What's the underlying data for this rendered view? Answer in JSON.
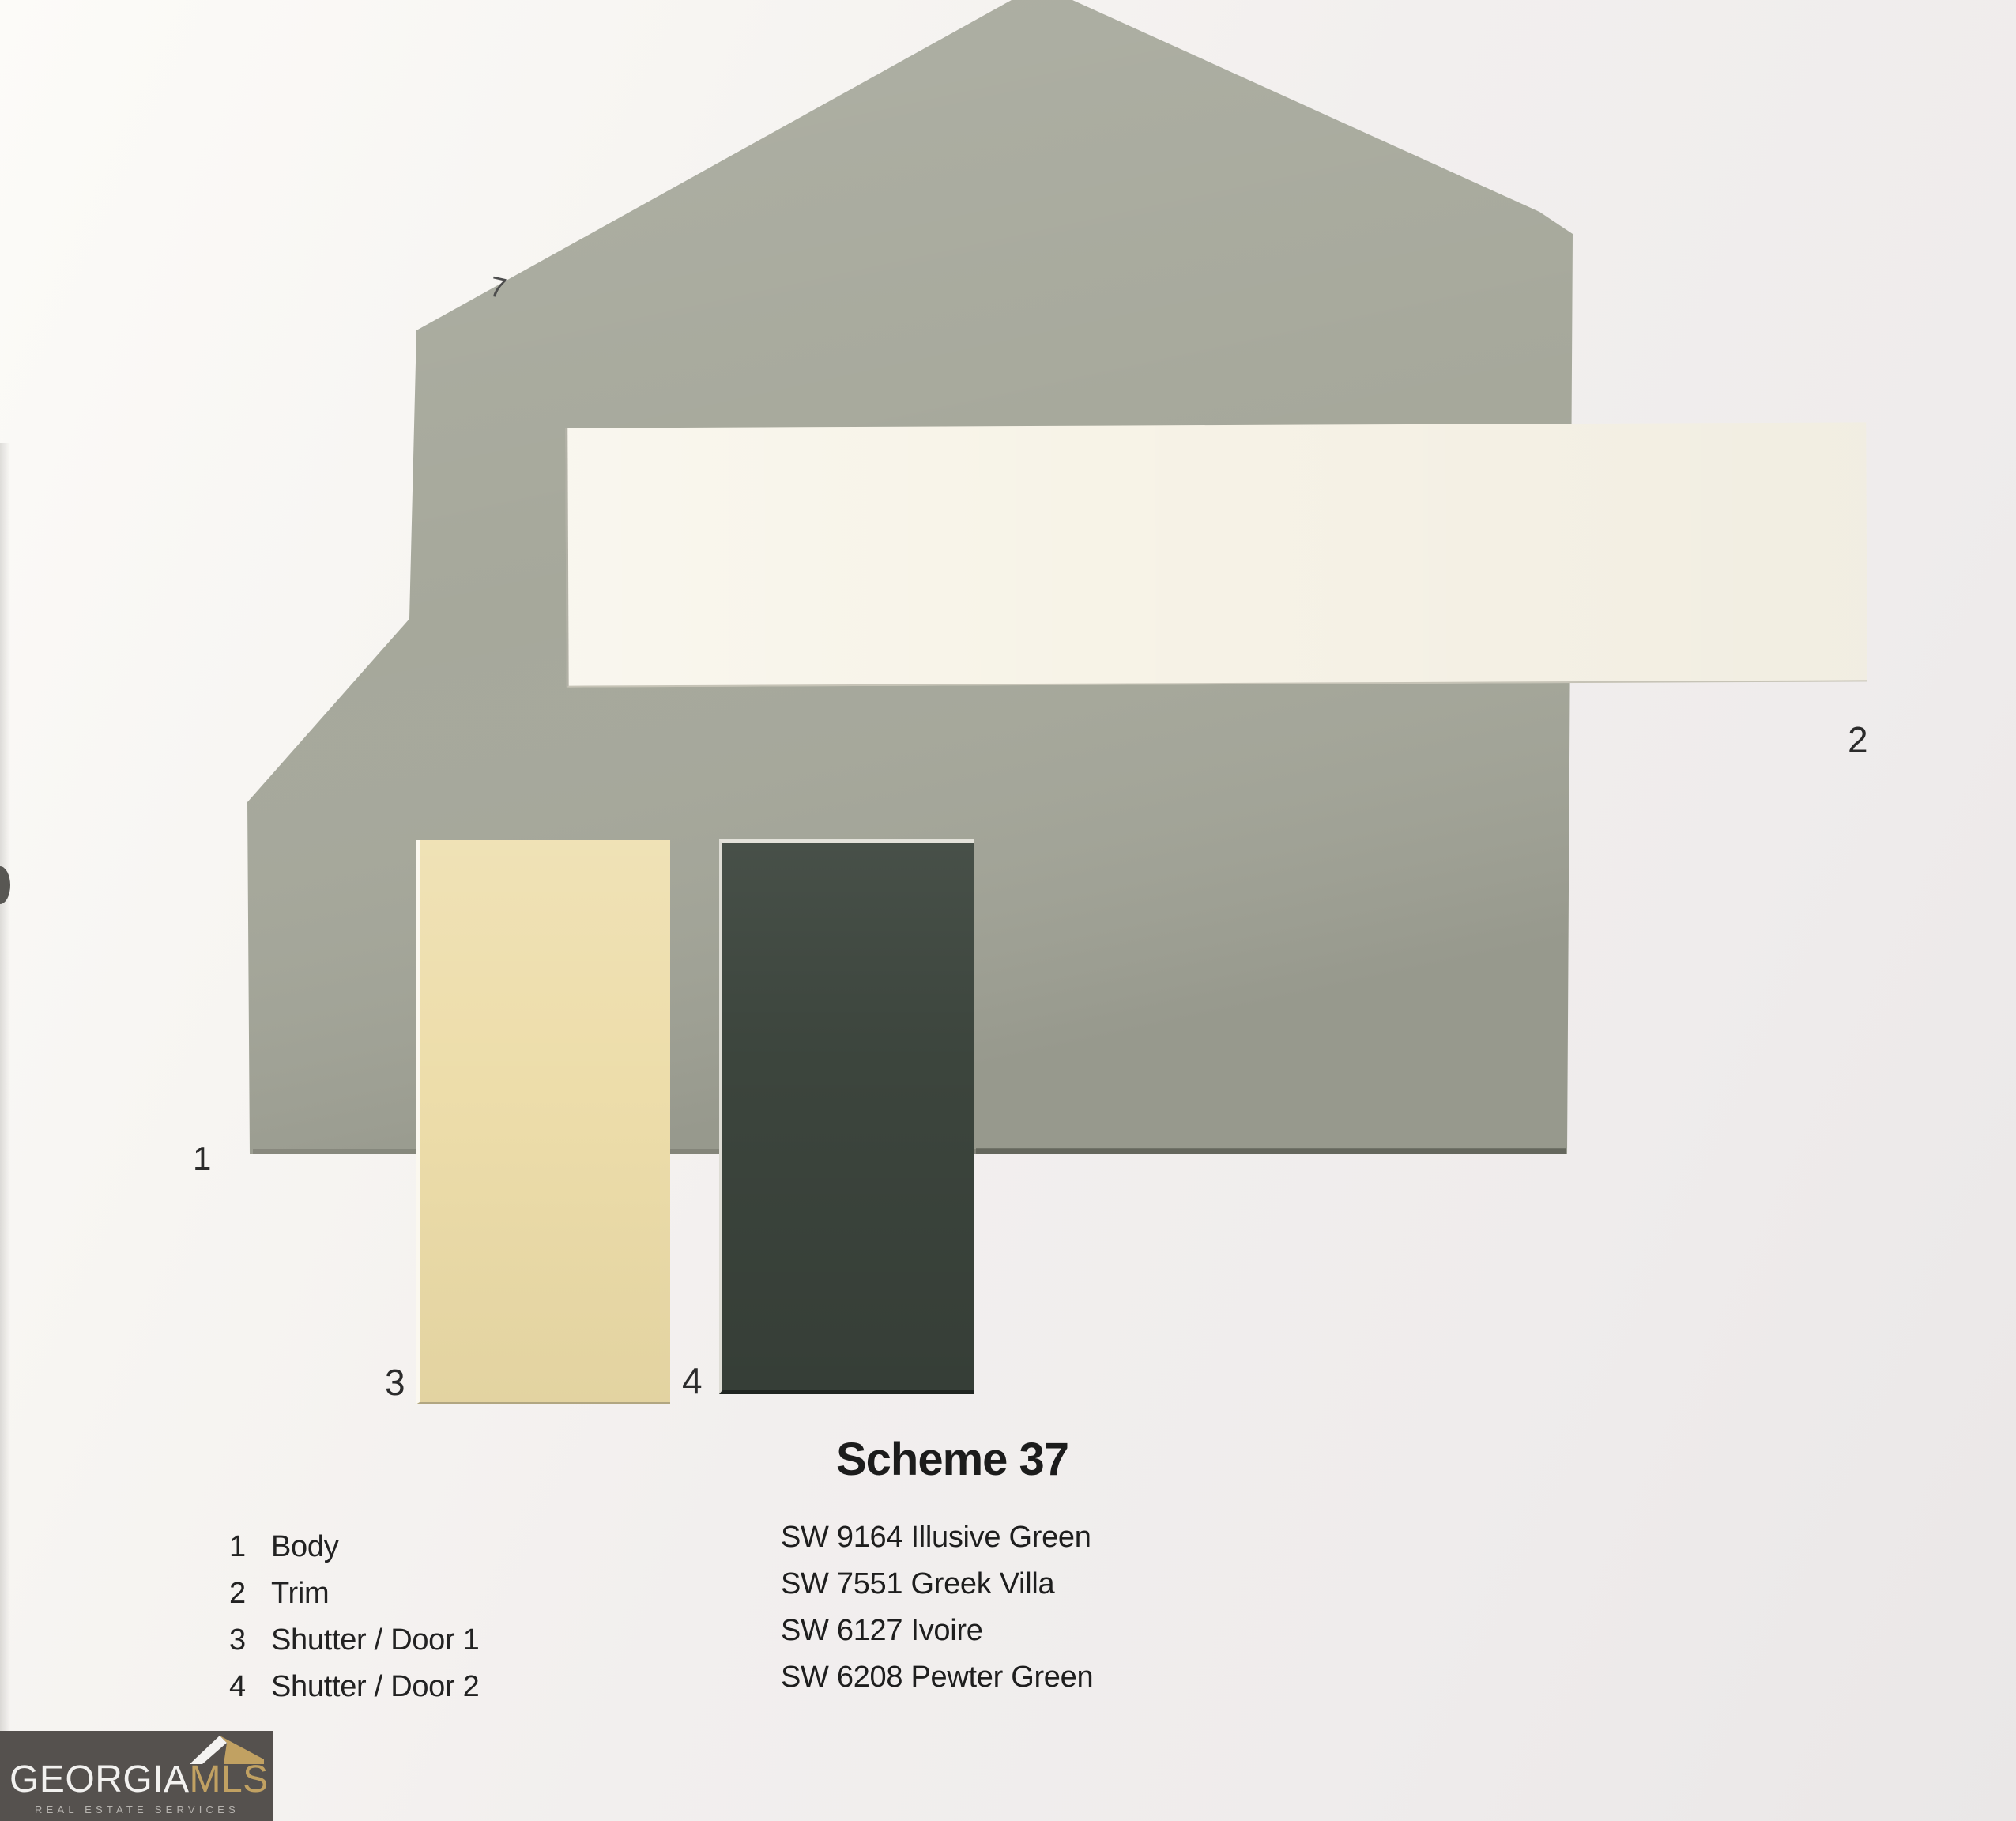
{
  "scheme": {
    "title": "Scheme 37",
    "legend": [
      {
        "num": "1",
        "label": "Body"
      },
      {
        "num": "2",
        "label": "Trim"
      },
      {
        "num": "3",
        "label": "Shutter / Door 1"
      },
      {
        "num": "4",
        "label": "Shutter / Door 2"
      }
    ],
    "colors": [
      {
        "marker": "1",
        "code": "SW 9164",
        "name": "Illusive Green",
        "label": "SW 9164 Illusive Green",
        "hex": "#a6a89b",
        "role": "Body"
      },
      {
        "marker": "2",
        "code": "SW 7551",
        "name": "Greek Villa",
        "label": "SW 7551 Greek Villa",
        "hex": "#f7f3e7",
        "role": "Trim"
      },
      {
        "marker": "3",
        "code": "SW 6127",
        "name": "Ivoire",
        "label": "SW 6127 Ivoire",
        "hex": "#edddaa",
        "role": "Shutter / Door 1"
      },
      {
        "marker": "4",
        "code": "SW 6208",
        "name": "Pewter Green",
        "label": "SW 6208 Pewter Green",
        "hex": "#3c453d",
        "role": "Shutter / Door 2"
      }
    ]
  },
  "logo": {
    "brand_primary": "GEORGIA",
    "brand_secondary": "MLS",
    "tagline": "REAL ESTATE SERVICES",
    "bg_hex": "#55514e",
    "gold_hex": "#c1a162",
    "text_hex": "#f2f1ef",
    "tagline_hex": "#b7b4b0"
  },
  "annotations": {
    "pen_mark": "7"
  }
}
